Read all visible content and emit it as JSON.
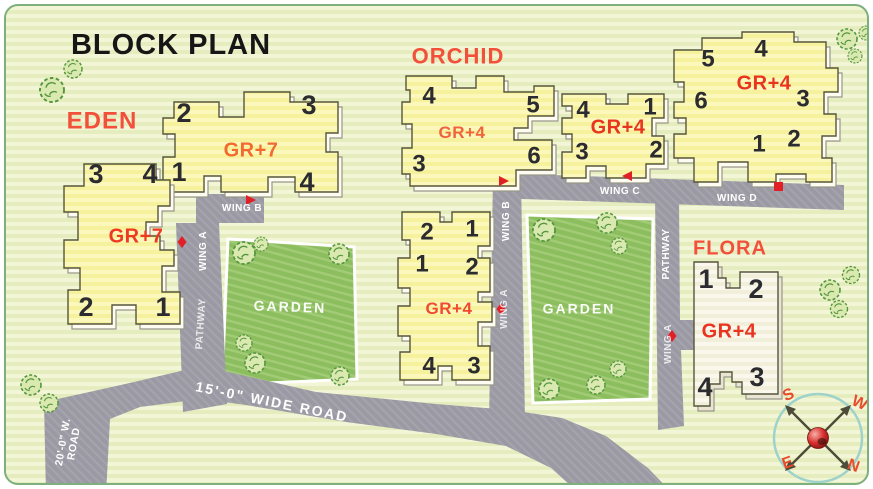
{
  "title": "BLOCK PLAN",
  "blocks": {
    "eden": {
      "name": "EDEN",
      "buildings": [
        {
          "floors": "GR+7",
          "units": [
            "2",
            "3",
            "1",
            "4"
          ]
        },
        {
          "floors": "GR+7",
          "units": [
            "3",
            "4",
            "2",
            "1"
          ]
        }
      ]
    },
    "orchid": {
      "name": "ORCHID",
      "buildings": [
        {
          "floors": "GR+4",
          "units": [
            "4",
            "5",
            "3",
            "6"
          ]
        },
        {
          "floors": "GR+4",
          "units": [
            "4",
            "1",
            "3",
            "2"
          ]
        },
        {
          "floors": "GR+4",
          "units": [
            "5",
            "4",
            "6",
            "3",
            "1",
            "2"
          ]
        },
        {
          "floors": "GR+4",
          "units": [
            "2",
            "1",
            "1",
            "2",
            "4",
            "3"
          ]
        }
      ]
    },
    "flora": {
      "name": "FLORA",
      "buildings": [
        {
          "floors": "GR+4",
          "units": [
            "1",
            "2",
            "4",
            "3"
          ]
        }
      ]
    }
  },
  "roads": {
    "wing_a": "WING A",
    "wing_b": "WING B",
    "wing_c": "WING C",
    "wing_d": "WING D",
    "pathway": "PATHWAY",
    "wide_road": "15'-0\" WIDE ROAD",
    "west_road_line1": "20'-0\" W.",
    "west_road_line2": "ROAD"
  },
  "garden_label": "GARDEN",
  "compass": {
    "south": "S",
    "west": "W",
    "east": "E",
    "north": "N"
  },
  "colors": {
    "building_yellow": "#f8f3a2",
    "flora_white": "#f3f0dd",
    "road_gray": "#9b9aa4",
    "garden_green": "#8cbd5e",
    "block_name_orange": "#f2503a",
    "floors_red": "#e93420",
    "marker_red": "#e11f26",
    "compass_letter_red": "#ea4a2c"
  }
}
